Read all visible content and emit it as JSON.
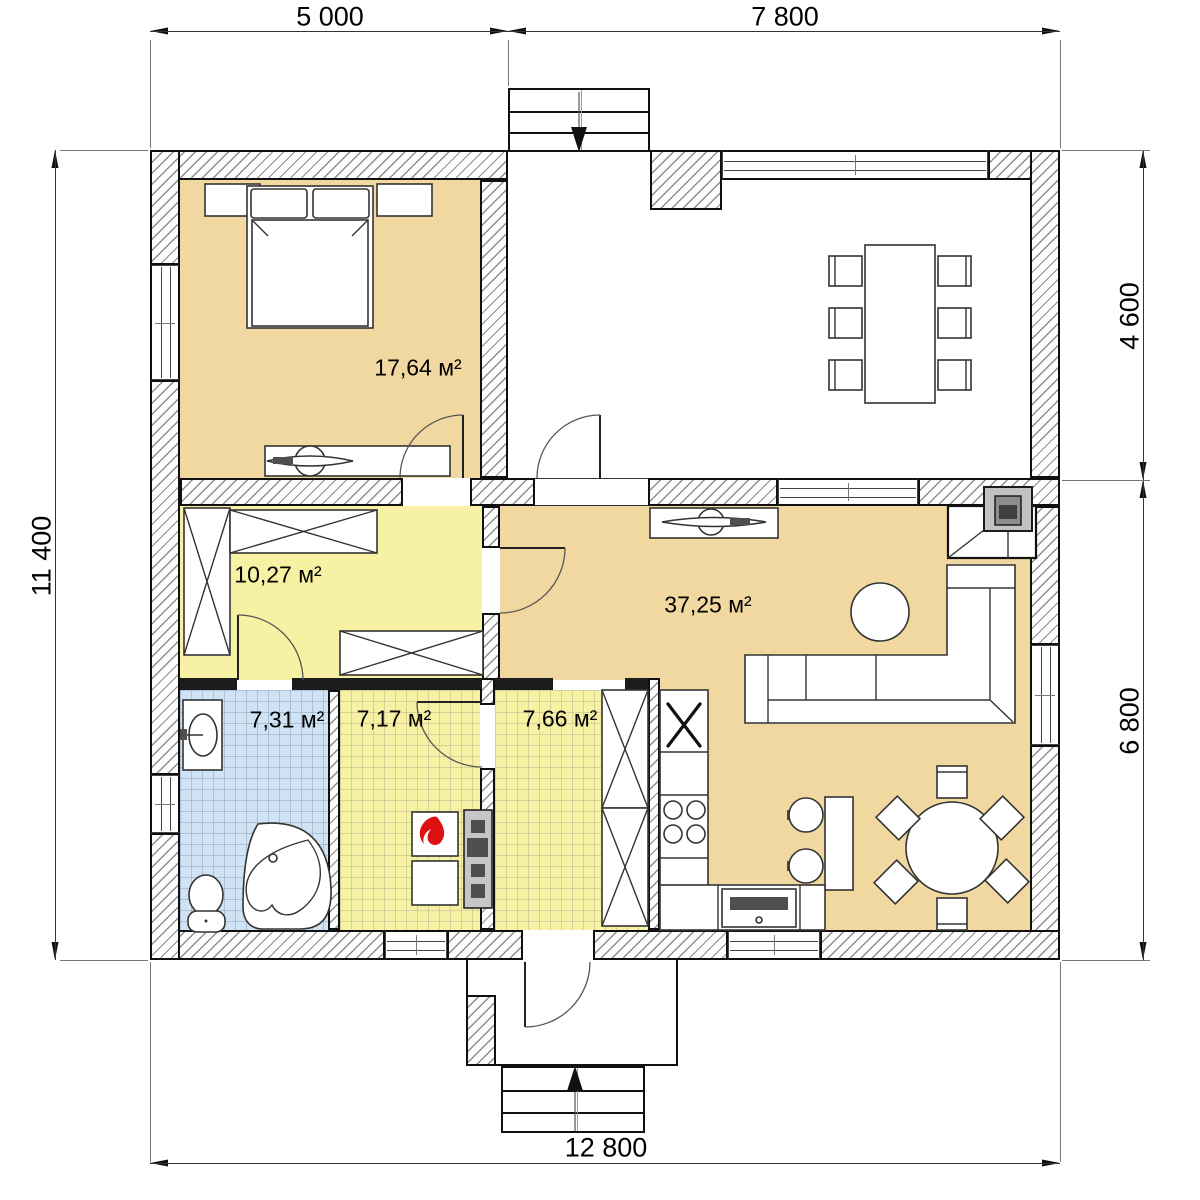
{
  "dim_labels": {
    "top": [
      "5 000",
      "7 800"
    ],
    "right": [
      "4 600",
      "6 800"
    ],
    "left": [
      "11 400"
    ],
    "bottom": [
      "12 800"
    ]
  },
  "rooms": {
    "bedroom": {
      "area": "17,64 м²"
    },
    "hallway": {
      "area": "10,27 м²"
    },
    "living": {
      "area": "37,25 м²"
    },
    "bathroom": {
      "area": "7,31 м²"
    },
    "boiler": {
      "area": "7,17 м²"
    },
    "tambour": {
      "area": "7,66 м²"
    }
  },
  "colors": {
    "room_tan": "#f0d8a0",
    "room_yellow": "#f6f1a3",
    "room_blue": "#cfe3f4",
    "flame_red": "#dd1111",
    "wall_line": "#101010"
  }
}
